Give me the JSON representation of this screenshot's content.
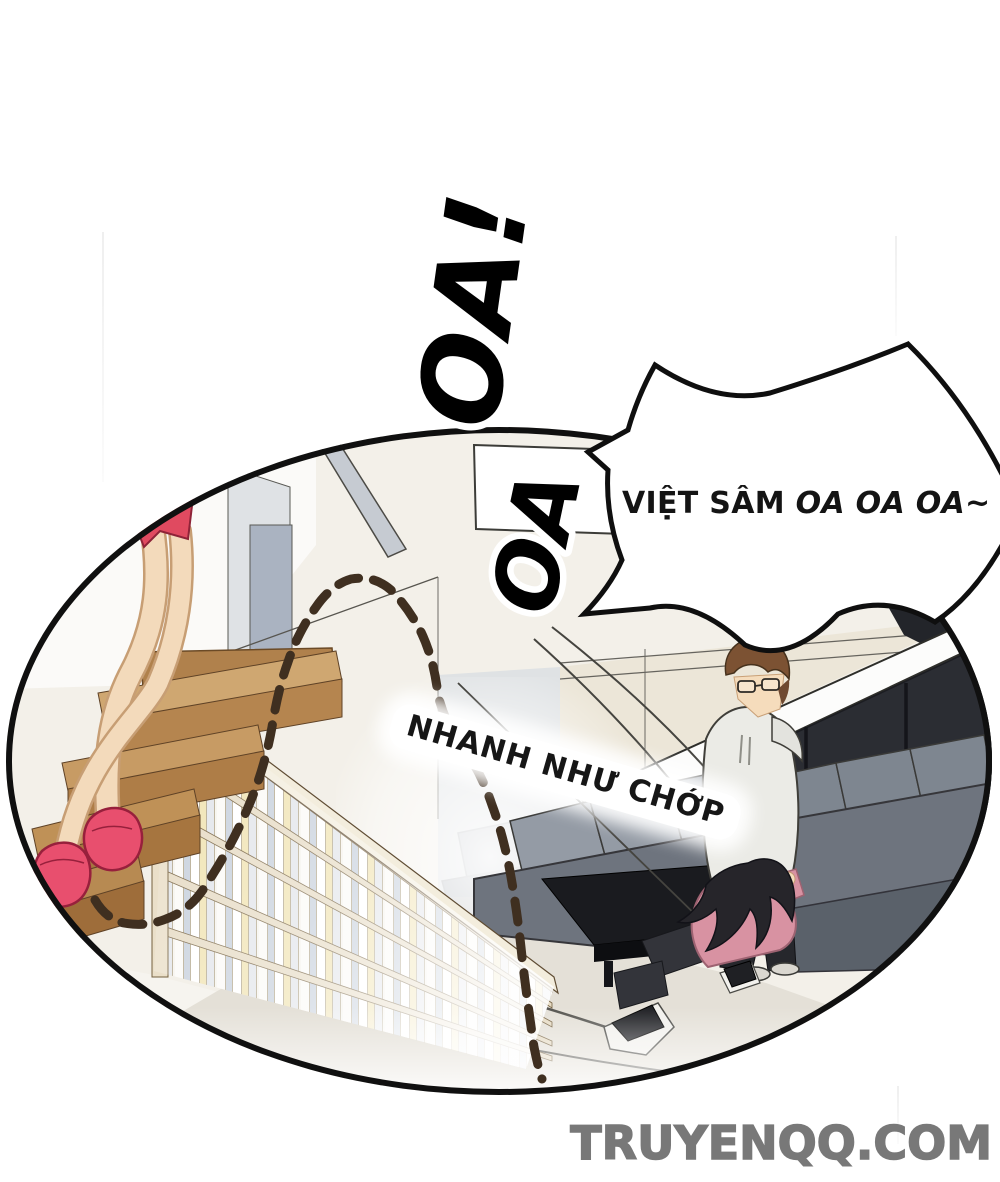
{
  "page": {
    "type": "comic-panel",
    "background": "#ffffff"
  },
  "speech_bubble": {
    "call": "VIỆT SÂM",
    "cry": "OA OA OA~",
    "full_text": "VIỆT SÂM OA OA OA~"
  },
  "sfx": {
    "big_cry_upper": "OA!",
    "big_cry_lower": "OA",
    "speed_caption": "NHANH NHƯ CHỚP"
  },
  "watermark": {
    "text": "TRUYENQQ.COM",
    "color": "#787878"
  },
  "palette": {
    "panel_bg": "#f3f0e9",
    "wall_white": "#fbfaf8",
    "wall_grey": "#dfe2e4",
    "pillar_grey": "#aab3c1",
    "ceiling_beam": "#c6cbd2",
    "window_dark": "#2b2d33",
    "window_frame": "#fcfcfb",
    "couch_grey": "#949ba5",
    "couch_dark": "#6e747e",
    "table_black": "#1a1b1f",
    "floor_beige": "#e4e0d7",
    "stairs_light": "#cfa771",
    "stairs_dark": "#ae7d47",
    "shelf_cream": "#f1ece0",
    "book_yellow": "#f0e3b2",
    "book_blue_grey": "#c7d0dc",
    "skin": "#f3dabb",
    "skirt_pink": "#e04a60",
    "slipper_pink": "#e84f6e",
    "hair_brown": "#7c5233",
    "hoodie_light": "#ebebe6",
    "sweater_pink": "#d892a2",
    "hair_black": "#26252a",
    "book_blue": "#6db3e0",
    "dash_line_brown": "#3f2f20",
    "outline_black": "#101010"
  }
}
